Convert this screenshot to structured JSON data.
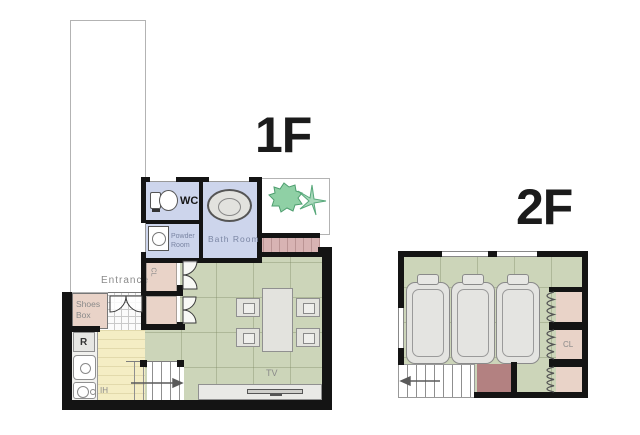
{
  "floor1": {
    "title": "1F",
    "labels": {
      "wc": "WC",
      "bath": "Bath Room",
      "powder1": "Powder",
      "powder2": "Room",
      "closet": "CL",
      "entrance": "Entrance",
      "shoes1": "Shoes",
      "shoes2": "Box",
      "fridge": "R",
      "stove": "IH",
      "tv": "TV"
    }
  },
  "floor2": {
    "title": "2F",
    "labels": {
      "closet": "CL"
    }
  },
  "colors": {
    "wall": "#141414",
    "living_floor": "#ccd5b9",
    "wet_floor": "#cdd5ec",
    "closet_floor": "#e9d3c8",
    "kitchen_floor": "#f4edc4",
    "deck": "#d8b3b3",
    "stair_block": "#b38181",
    "plant": "#8fd0a5",
    "label_text": "#8a8a8a"
  },
  "icons": {
    "toilet": "toilet-icon",
    "washing_machine": "washer-icon",
    "bathtub": "bathtub-icon",
    "plants": "plant-icon",
    "kitchen_sink": "sink-icon",
    "ih_stove": "ih-stove-icon",
    "tv_set": "tv-icon",
    "bed": "bed-icon",
    "dining_table": "dining-table-icon",
    "chair": "chair-icon",
    "stairs": "stairs-icon",
    "door_swing": "door-arc-icon",
    "accordion_door": "accordion-door-icon"
  }
}
